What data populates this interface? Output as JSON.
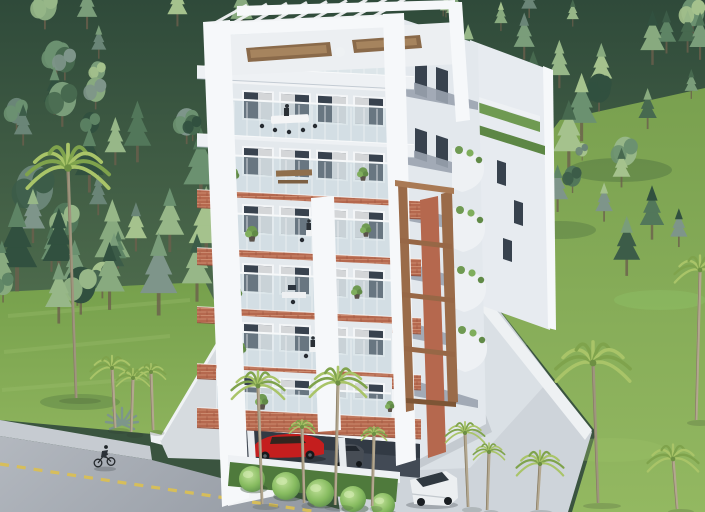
{
  "scene": {
    "type": "architectural-render",
    "view": "aerial-three-quarter",
    "time_of_day": "day",
    "description": "Photorealistic CGI aerial rendering of a modern white seven-storey apartment building with terracotta brick accent bands, a rooftop pergola terrace with lounge furniture, glass-railed balconies with plants and people, a wooden trellis corner, covered ground-floor parking with a red sports car and a grey car, surrounded by dense pine forest, bright lawns, palm trees, a front road with yellow dashed markings and a cyclist, a side driveway, and a parked white van"
  },
  "colors": {
    "forest_dark": "#31503f",
    "forest_mid": "#5e8465",
    "forest_light": "#97b788",
    "lawn": "#84aa55",
    "lawn_light": "#9cc068",
    "grass_left": "#7ba24e",
    "road": "#a2a8b0",
    "sidewalk": "#c6cbd1",
    "road_marking": "#d9bf55",
    "driveway": "#ced4da",
    "driveway_light": "#dde2e7",
    "curb": "#eef1f3",
    "building_white": "#f2f4f6",
    "building_shadow": "#e3e8ed",
    "slab_white": "#eef1f4",
    "accent_brick": "#b5684e",
    "accent_brick_light": "#cf8a6d",
    "wood_trellis": "#9a6b49",
    "wood_furniture": "#8a6a4a",
    "glass": "#38424e",
    "glass_railing": "#b9cdd6",
    "curtain": "#e9eaec",
    "interior": "#e4e9ed",
    "plant_green": "#6f9a52",
    "bush_green": "#86bb5f",
    "car_red": "#c41e1e",
    "car_grey": "#474d55",
    "van_white": "#eceff1",
    "parking_shadow": "#424a55",
    "palm_frond": "#a9c468",
    "palm_frond_dark": "#7fa34c",
    "palm_trunk": "#b3a78f",
    "people": "#2a3036",
    "side_stripe": "#9aa3af"
  },
  "objects": {
    "building": {
      "label": "apartment-building",
      "floors_visible": 7,
      "features": [
        "rooftop-pergola",
        "roof-terrace-lounge",
        "glass-balcony-railings",
        "terracotta-brick-bands",
        "balcony-plants",
        "wood-trellis-corner",
        "scalloped-side-balconies",
        "green-roof-strips",
        "covered-parking"
      ]
    },
    "vehicles": [
      {
        "label": "red-sports-car"
      },
      {
        "label": "grey-car"
      },
      {
        "label": "white-van"
      },
      {
        "label": "bicycle-with-rider"
      }
    ],
    "vegetation": [
      "pine-forest",
      "palm-trees",
      "lawns",
      "agave",
      "round-hedge-bushes",
      "planter-shrubs"
    ],
    "circulation": [
      "front-road-with-yellow-dashes",
      "sidewalk",
      "entrance-walkway",
      "side-driveway"
    ]
  },
  "forest": {
    "seed": 11,
    "conifer_ratio": 0.72,
    "palette": [
      "#31503f",
      "#3c5c48",
      "#47694f",
      "#52775a",
      "#5e8465",
      "#6b9170",
      "#7a9d7a",
      "#88aa7f",
      "#97b788",
      "#7e958a",
      "#6a8577",
      "#a5c28d"
    ],
    "regions": [
      {
        "x0": 0,
        "x1": 705,
        "y0": 8,
        "y1": 120,
        "n": 44,
        "smin": 14,
        "smax": 30
      },
      {
        "x0": 0,
        "x1": 260,
        "y0": 110,
        "y1": 298,
        "n": 26,
        "smin": 18,
        "smax": 40
      },
      {
        "x0": 420,
        "x1": 705,
        "y0": 70,
        "y1": 200,
        "n": 18,
        "smin": 16,
        "smax": 34
      },
      {
        "x0": 555,
        "x1": 705,
        "y0": 150,
        "y1": 275,
        "n": 8,
        "smin": 14,
        "smax": 26
      },
      {
        "x0": 0,
        "x1": 140,
        "y0": 250,
        "y1": 326,
        "n": 9,
        "smin": 16,
        "smax": 30
      }
    ]
  },
  "building_front": {
    "xLeft": 205,
    "xRight": 421,
    "slope": 0.051,
    "bands": [
      {
        "name": "roof-slab",
        "y": 66,
        "h": 13,
        "type": "white",
        "glassH": 38,
        "doors": false
      },
      {
        "name": "floor6-slab",
        "y": 134,
        "h": 13,
        "type": "white",
        "glassH": 36,
        "doors": true
      },
      {
        "name": "floor5-band",
        "y": 190,
        "h": 18,
        "type": "brick",
        "glassH": 36,
        "doors": true
      },
      {
        "name": "floor4-band",
        "y": 248,
        "h": 17,
        "type": "brick",
        "glassH": 36,
        "doors": true
      },
      {
        "name": "floor3-band",
        "y": 307,
        "h": 16,
        "type": "brick",
        "glassH": 36,
        "doors": true
      },
      {
        "name": "floor2-band",
        "y": 364,
        "h": 15,
        "type": "brick",
        "glassH": 34,
        "doors": true
      },
      {
        "name": "canopy-band",
        "y": 408,
        "h": 20,
        "type": "brick",
        "glassH": 24,
        "doors": true
      }
    ]
  },
  "pergola": {
    "rafters": 9
  },
  "palms": [
    {
      "x": 68,
      "y": 168,
      "s": 42,
      "len": 230,
      "lean": 8
    },
    {
      "x": 112,
      "y": 368,
      "s": 22,
      "len": 60,
      "lean": 3
    },
    {
      "x": 133,
      "y": 378,
      "s": 17,
      "len": 54,
      "lean": -2
    },
    {
      "x": 151,
      "y": 372,
      "s": 15,
      "len": 58,
      "lean": 2
    },
    {
      "x": 258,
      "y": 386,
      "s": 27,
      "len": 118,
      "lean": 4
    },
    {
      "x": 338,
      "y": 383,
      "s": 29,
      "len": 122,
      "lean": -3
    },
    {
      "x": 302,
      "y": 427,
      "s": 13,
      "len": 76,
      "lean": 2
    },
    {
      "x": 374,
      "y": 434,
      "s": 13,
      "len": 72,
      "lean": -2
    },
    {
      "x": 465,
      "y": 433,
      "s": 20,
      "len": 74,
      "lean": 3
    },
    {
      "x": 489,
      "y": 452,
      "s": 16,
      "len": 58,
      "lean": -2
    },
    {
      "x": 593,
      "y": 363,
      "s": 38,
      "len": 140,
      "lean": 5
    },
    {
      "x": 540,
      "y": 464,
      "s": 24,
      "len": 46,
      "lean": -3
    },
    {
      "x": 673,
      "y": 459,
      "s": 26,
      "len": 50,
      "lean": 4
    },
    {
      "x": 700,
      "y": 270,
      "s": 26,
      "len": 150,
      "lean": -4
    }
  ],
  "bushes": [
    {
      "x": 252,
      "y": 479,
      "r": 13
    },
    {
      "x": 286,
      "y": 486,
      "r": 14
    },
    {
      "x": 320,
      "y": 493,
      "r": 14
    },
    {
      "x": 353,
      "y": 499,
      "r": 13
    },
    {
      "x": 383,
      "y": 505,
      "r": 12
    }
  ],
  "balcony_plants": [
    {
      "x": 233,
      "y": 178,
      "s": 7
    },
    {
      "x": 363,
      "y": 176,
      "s": 6
    },
    {
      "x": 252,
      "y": 236,
      "s": 7
    },
    {
      "x": 366,
      "y": 232,
      "s": 6
    },
    {
      "x": 236,
      "y": 296,
      "s": 7
    },
    {
      "x": 357,
      "y": 294,
      "s": 6
    },
    {
      "x": 240,
      "y": 352,
      "s": 7
    },
    {
      "x": 262,
      "y": 404,
      "s": 7
    },
    {
      "x": 390,
      "y": 408,
      "s": 5
    }
  ],
  "road_dashes": {
    "dash": 9,
    "gap": 8
  }
}
